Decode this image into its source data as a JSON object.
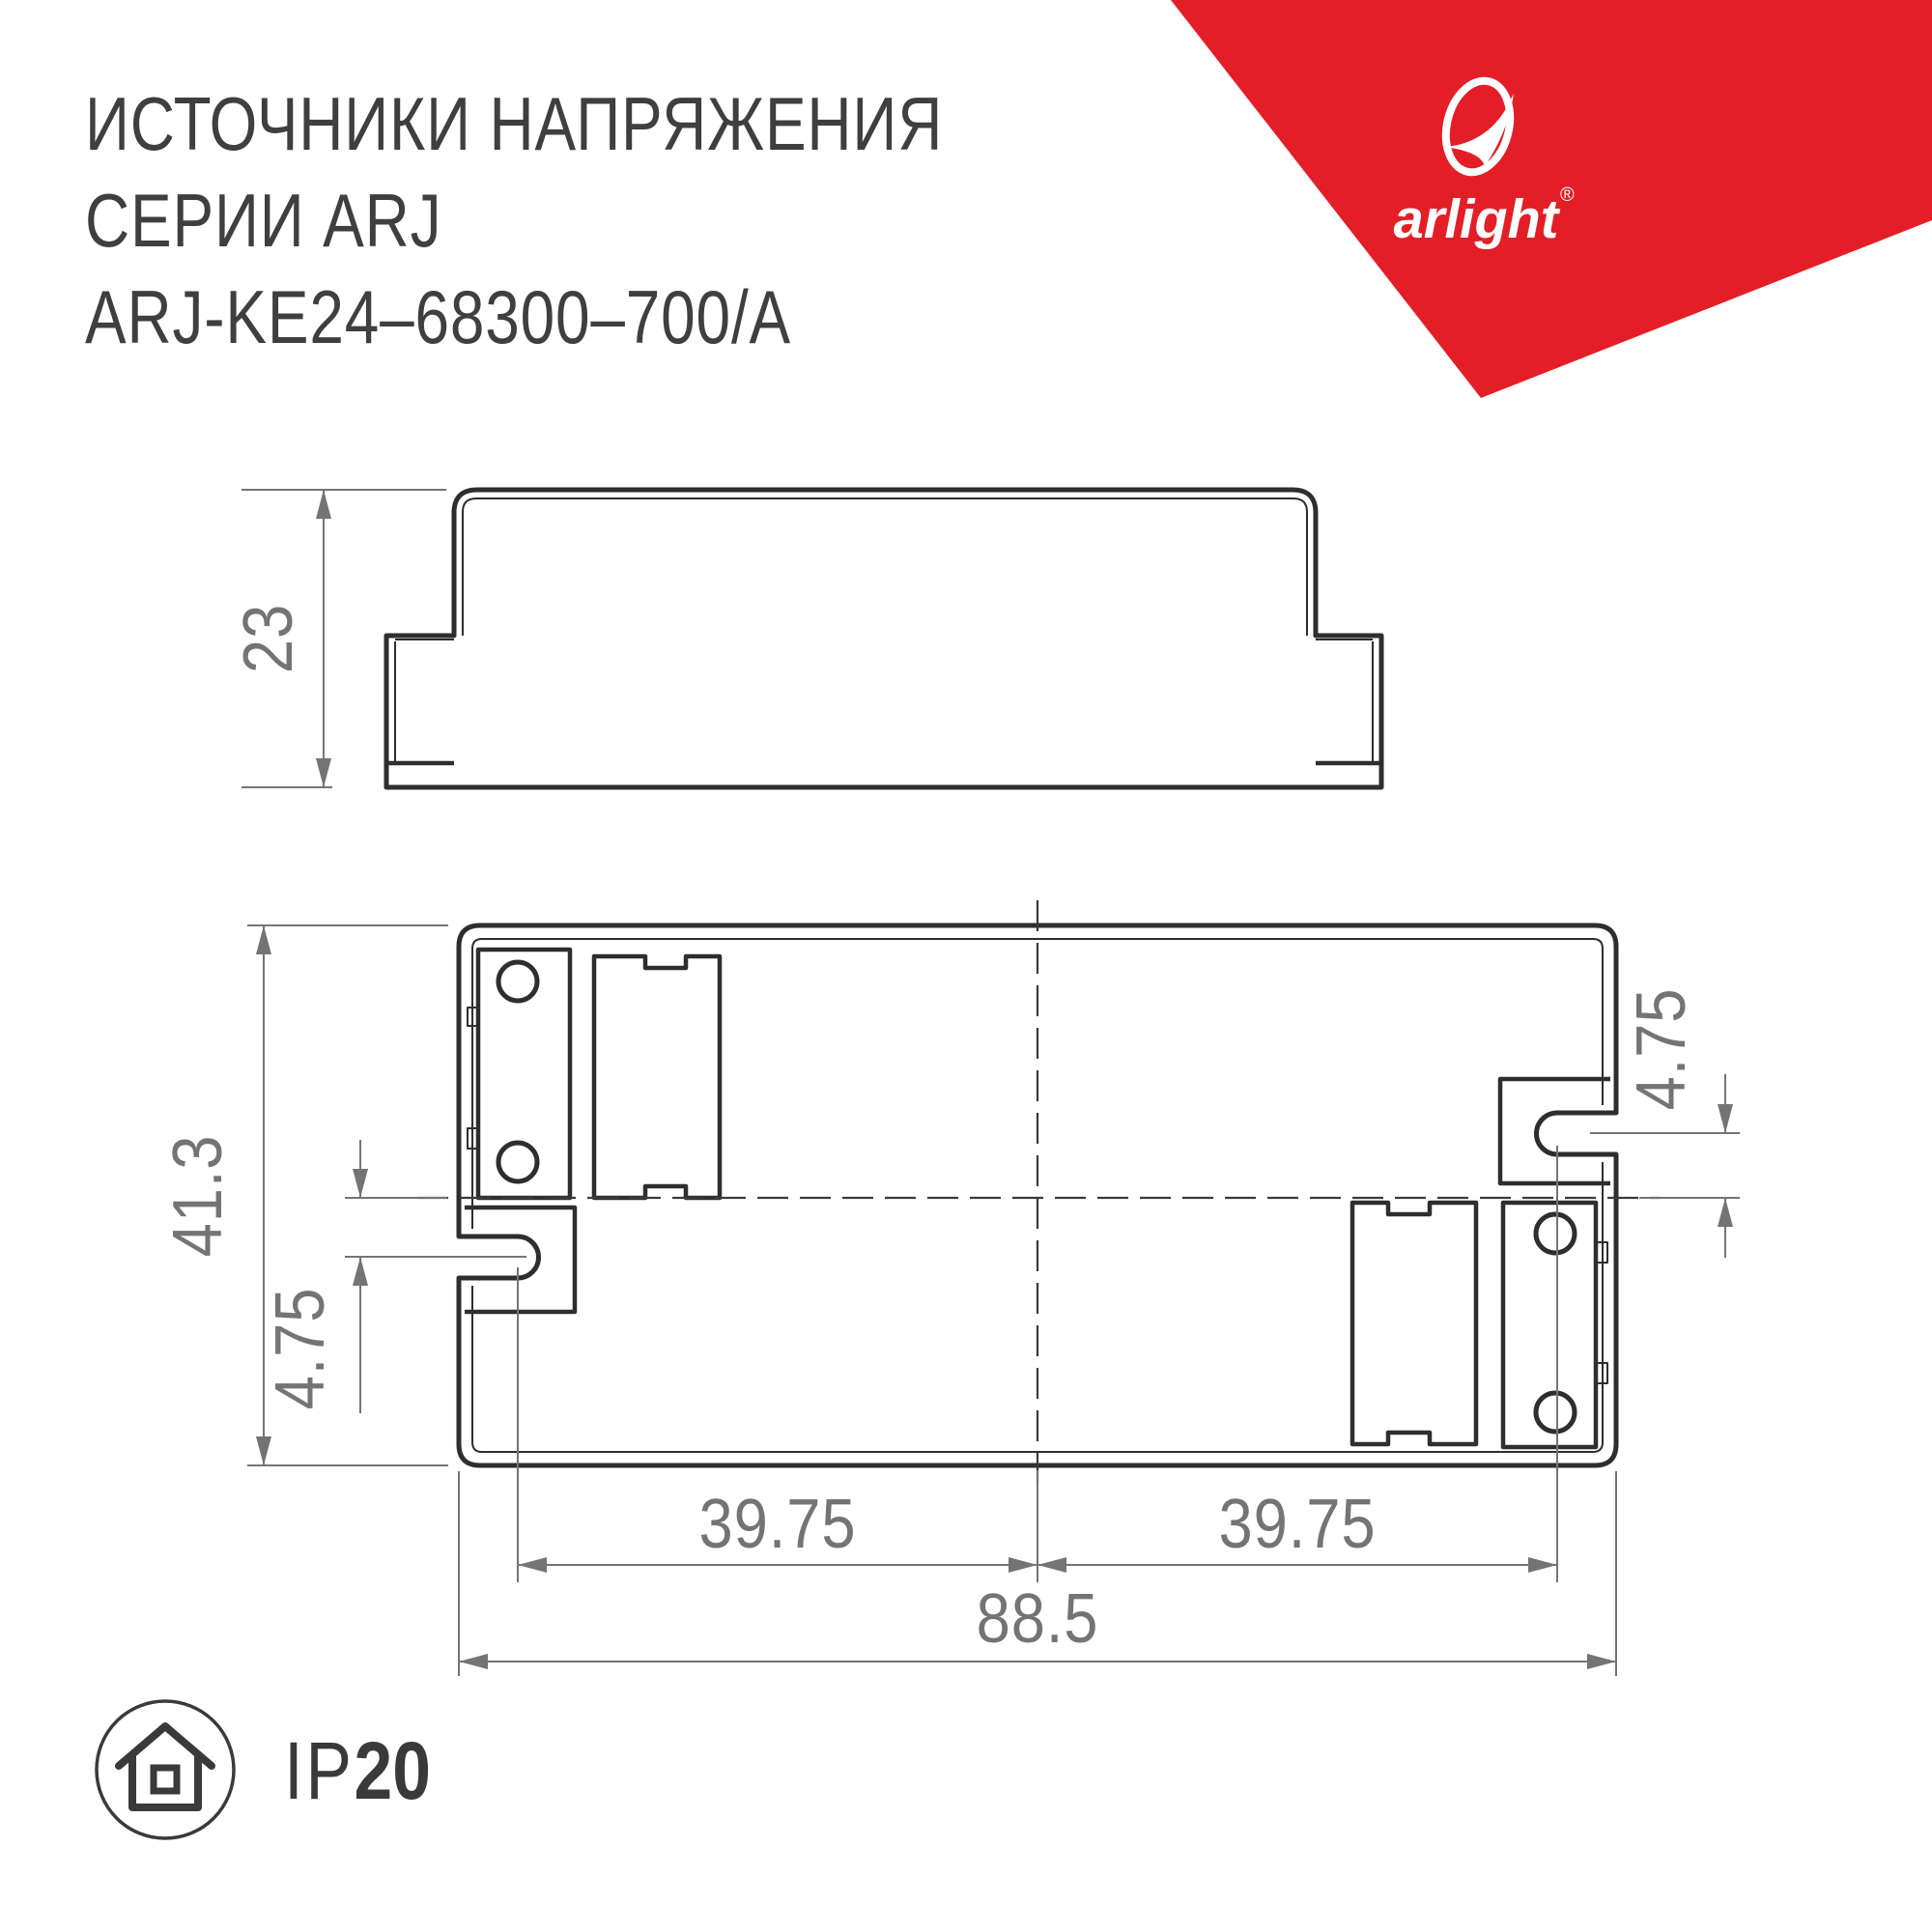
{
  "header": {
    "title_lines": [
      "ИСТОЧНИКИ НАПРЯЖЕНИЯ",
      "СЕРИИ ARJ",
      "ARJ-KE24–68300–700/A"
    ]
  },
  "logo": {
    "brand": "arlight",
    "reg": "®"
  },
  "drawings": {
    "side_view": {
      "height": "23"
    },
    "top_view": {
      "height": "41.3",
      "slot_offset_left": "4.75",
      "slot_offset_right": "4.75",
      "slot_span_left": "39.75",
      "slot_span_right": "39.75",
      "total_length": "88.5"
    }
  },
  "badges": {
    "ip_label": "IP",
    "ip_value": "20"
  },
  "colors": {
    "accent_red": "#e41e26",
    "drawing_line": "#2e2e2e",
    "dimension_gray": "#747474",
    "text_dark": "#3f3f3f"
  }
}
